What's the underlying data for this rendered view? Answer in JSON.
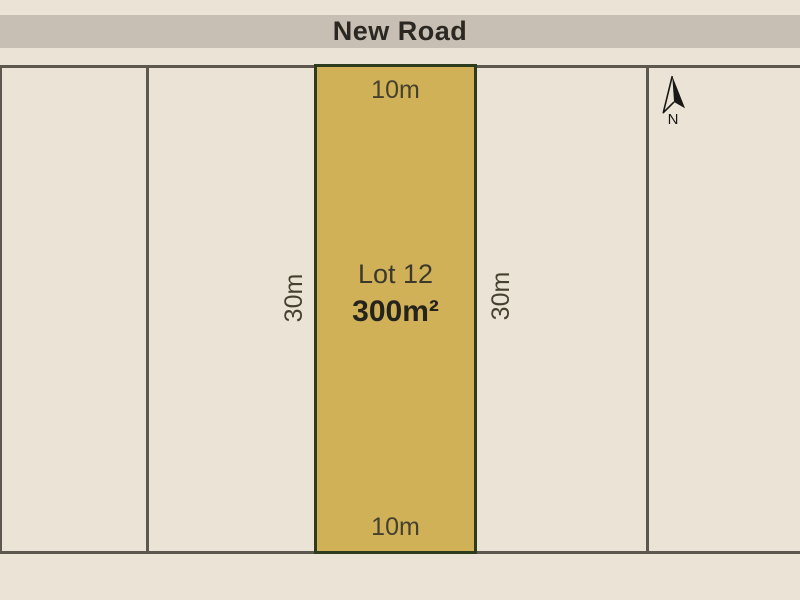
{
  "road": {
    "name": "New Road"
  },
  "lot": {
    "name": "Lot 12",
    "area": "300m²",
    "frontage_top": "10m",
    "frontage_bottom": "10m",
    "depth_left": "30m",
    "depth_right": "30m"
  },
  "compass": {
    "label": "N"
  },
  "colors": {
    "background": "#ebe3d6",
    "road_band": "#c7bfb3",
    "road_text": "#2b2823",
    "boundary_line": "#5c5850",
    "lot_fill": "#d1b158",
    "lot_border": "#2e3c1e",
    "label_text": "#45412f",
    "lot_name_text": "#3b392e",
    "area_text": "#24231c",
    "compass": "#181816"
  }
}
